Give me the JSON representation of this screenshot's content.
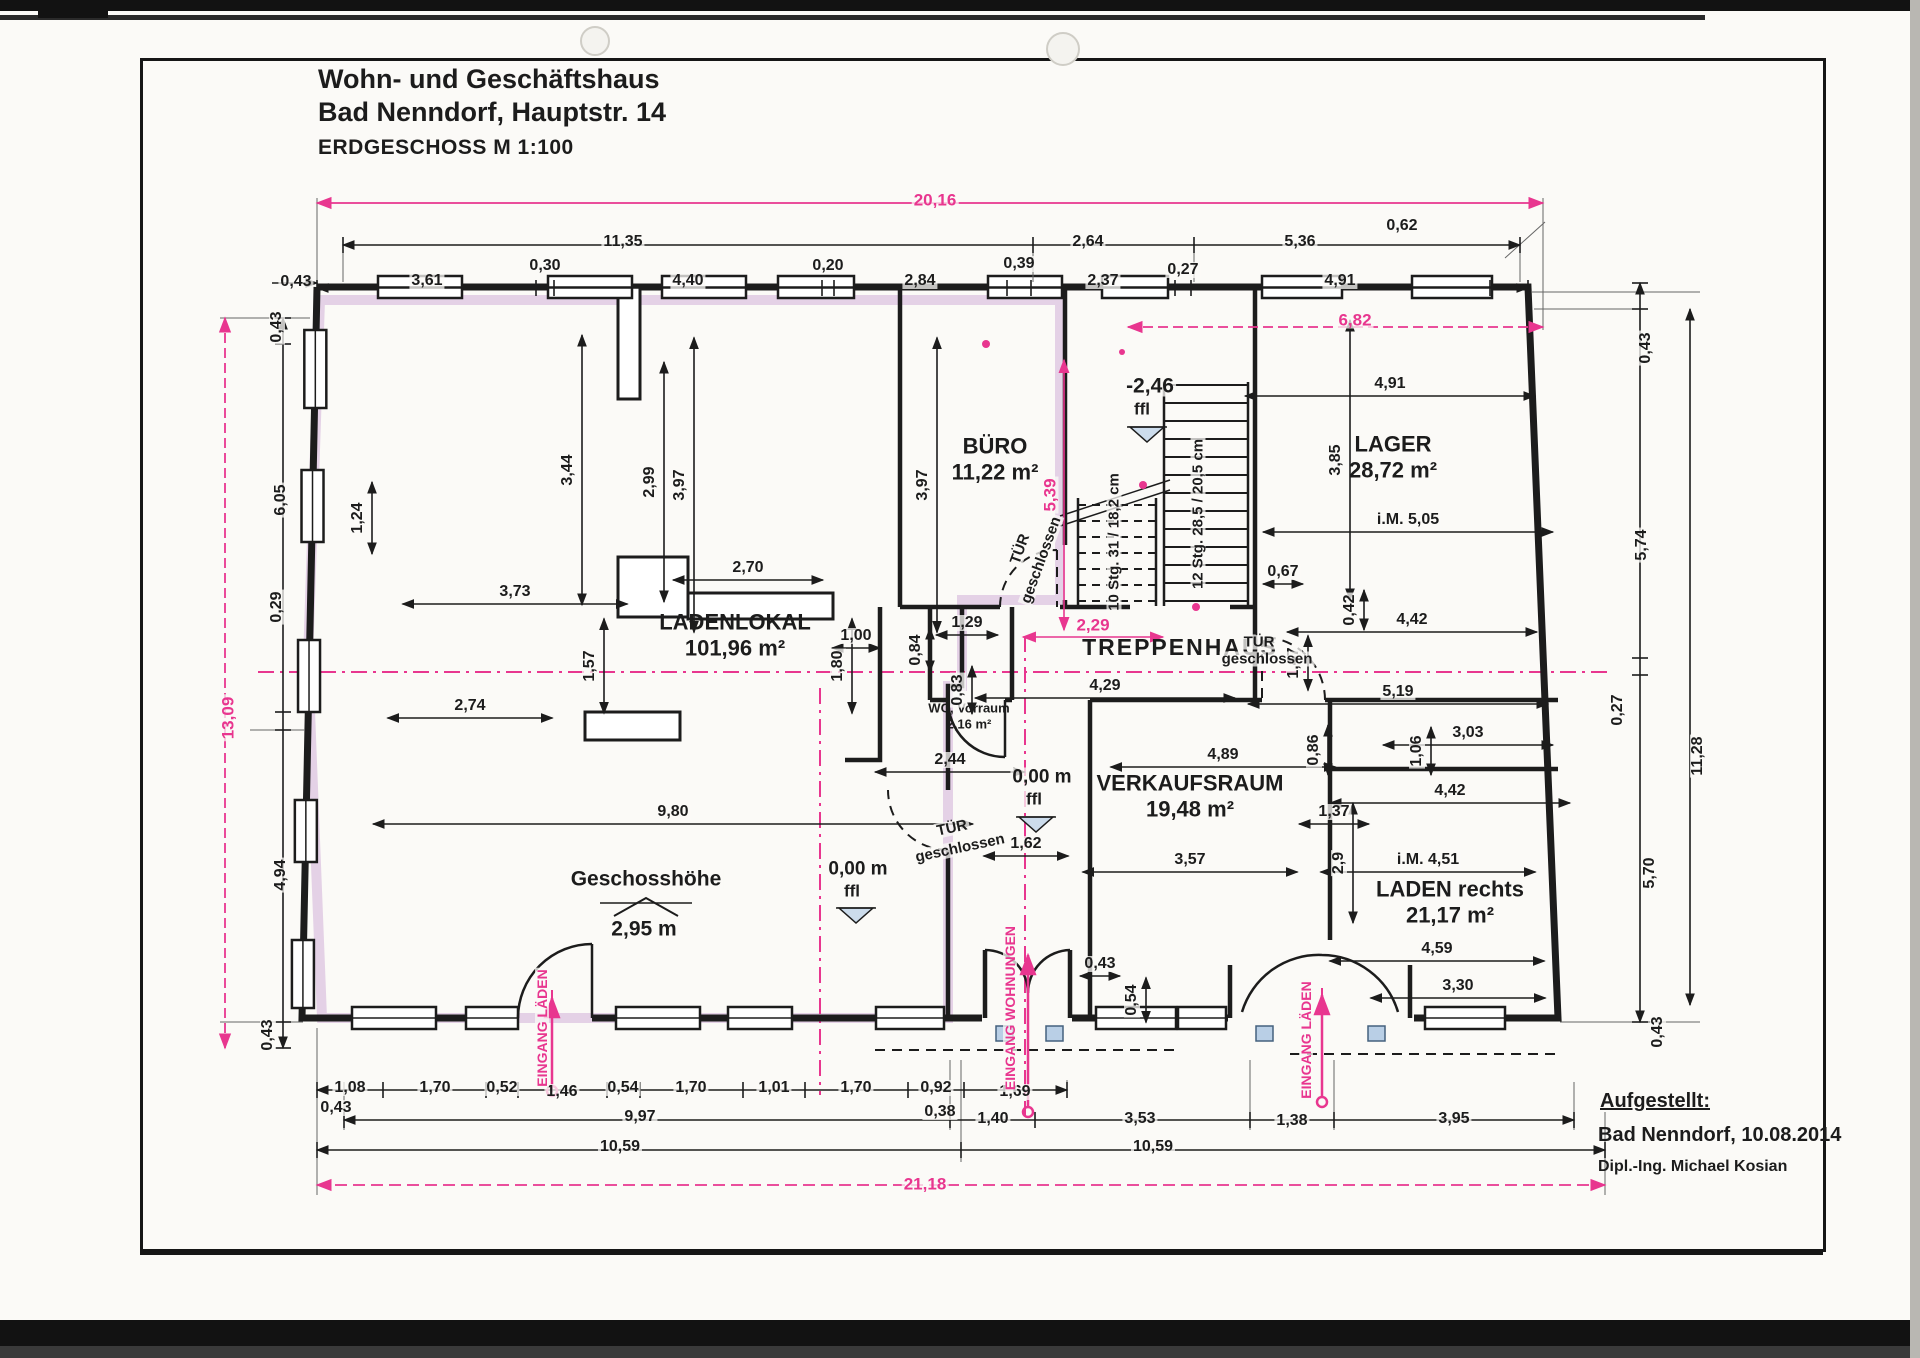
{
  "title": {
    "line1": "Wohn- und Geschäftshaus",
    "line2": "Bad Nenndorf, Hauptstr. 14",
    "scale_label": "ERDGESCHOSS M 1:100"
  },
  "attribution": {
    "heading": "Aufgestellt:",
    "line1": "Bad Nenndorf, 10.08.2014",
    "line2": "Dipl.-Ing. Michael Kosian"
  },
  "colors": {
    "ink": "#1c1c1c",
    "accent_pink": "#e8368f",
    "wall_highlight": "#c79fd0",
    "window_blue": "#b9cfe6",
    "paper": "#fbfaf7"
  },
  "rooms": [
    {
      "name": "LADENLOKAL",
      "area": "101,96 m²",
      "x": 735,
      "y": 636,
      "size": 22
    },
    {
      "name": "BÜRO",
      "area": "11,22 m²",
      "x": 995,
      "y": 460,
      "size": 22
    },
    {
      "name": "LAGER",
      "area": "28,72 m²",
      "x": 1393,
      "y": 458,
      "size": 22
    },
    {
      "name": "TREPPENHAUS",
      "area": "",
      "x": 1180,
      "y": 648,
      "size": 23
    },
    {
      "name": "VERKAUFSRAUM",
      "area": "19,48 m²",
      "x": 1190,
      "y": 797,
      "size": 22
    },
    {
      "name": "LADEN rechts",
      "area": "21,17 m²",
      "x": 1450,
      "y": 903,
      "size": 22
    },
    {
      "name": "WC, Vorraum",
      "area": "2,16 m²",
      "x": 969,
      "y": 716,
      "size": 13
    }
  ],
  "annotations": [
    {
      "t": "TÜR",
      "x": 1020,
      "y": 549,
      "rot": -70,
      "size": 15
    },
    {
      "t": "geschlossen",
      "x": 1041,
      "y": 560,
      "rot": -70,
      "size": 15
    },
    {
      "t": "TÜR",
      "x": 1259,
      "y": 642,
      "size": 15
    },
    {
      "t": "geschlossen",
      "x": 1267,
      "y": 659,
      "size": 15
    },
    {
      "t": "TÜR",
      "x": 952,
      "y": 828,
      "rot": -12,
      "size": 15
    },
    {
      "t": "geschlossen",
      "x": 960,
      "y": 848,
      "rot": -12,
      "size": 15
    },
    {
      "t": "10 Stg. 31 / 18,2 cm",
      "x": 1114,
      "y": 542,
      "rot": -90,
      "size": 15
    },
    {
      "t": "12 Stg. 28,5 / 20,5 cm",
      "x": 1198,
      "y": 514,
      "rot": -90,
      "size": 15
    },
    {
      "t": "-2,46",
      "x": 1150,
      "y": 386,
      "size": 21
    },
    {
      "t": "ffl",
      "x": 1142,
      "y": 409,
      "size": 17
    },
    {
      "t": "0,00 m",
      "x": 858,
      "y": 869,
      "size": 19
    },
    {
      "t": "ffl",
      "x": 852,
      "y": 891,
      "size": 17
    },
    {
      "t": "0,00 m",
      "x": 1042,
      "y": 777,
      "size": 19
    },
    {
      "t": "ffl",
      "x": 1034,
      "y": 799,
      "size": 17
    },
    {
      "t": "Geschosshöhe",
      "x": 646,
      "y": 879,
      "size": 21
    },
    {
      "t": "2,95 m",
      "x": 644,
      "y": 929,
      "size": 21
    },
    {
      "t": "EINGANG LÄDEN",
      "x": 542,
      "y": 1028,
      "rot": -90,
      "pink": true,
      "size": 14
    },
    {
      "t": "EINGANG WOHNUNGEN",
      "x": 1010,
      "y": 1008,
      "rot": -90,
      "pink": true,
      "size": 14
    },
    {
      "t": "EINGANG LÄDEN",
      "x": 1306,
      "y": 1040,
      "rot": -90,
      "pink": true,
      "size": 14
    }
  ],
  "dims_black": [
    {
      "t": "0,43",
      "x": 296,
      "y": 282
    },
    {
      "t": "11,35",
      "x": 623,
      "y": 242
    },
    {
      "t": "2,64",
      "x": 1088,
      "y": 242
    },
    {
      "t": "5,36",
      "x": 1300,
      "y": 242
    },
    {
      "t": "3,61",
      "x": 427,
      "y": 281
    },
    {
      "t": "0,30",
      "x": 545,
      "y": 266
    },
    {
      "t": "4,40",
      "x": 688,
      "y": 281
    },
    {
      "t": "0,20",
      "x": 828,
      "y": 266
    },
    {
      "t": "2,84",
      "x": 920,
      "y": 281
    },
    {
      "t": "0,39",
      "x": 1019,
      "y": 264
    },
    {
      "t": "2,37",
      "x": 1103,
      "y": 281
    },
    {
      "t": "0,27",
      "x": 1183,
      "y": 270
    },
    {
      "t": "4,91",
      "x": 1340,
      "y": 281
    },
    {
      "t": "0,62",
      "x": 1402,
      "y": 226
    },
    {
      "t": "0,43",
      "x": 277,
      "y": 327,
      "r": 1
    },
    {
      "t": "6,05",
      "x": 281,
      "y": 500,
      "r": 1
    },
    {
      "t": "0,29",
      "x": 277,
      "y": 607,
      "r": 1
    },
    {
      "t": "4,94",
      "x": 281,
      "y": 875,
      "r": 1
    },
    {
      "t": "0,43",
      "x": 268,
      "y": 1035,
      "r": 1
    },
    {
      "t": "0,43",
      "x": 1646,
      "y": 348,
      "r": 1
    },
    {
      "t": "5,74",
      "x": 1642,
      "y": 545,
      "r": 1
    },
    {
      "t": "0,27",
      "x": 1618,
      "y": 710,
      "r": 1
    },
    {
      "t": "5,70",
      "x": 1650,
      "y": 873,
      "r": 1
    },
    {
      "t": "0,43",
      "x": 1658,
      "y": 1032,
      "r": 1
    },
    {
      "t": "11,28",
      "x": 1698,
      "y": 756,
      "r": 1
    },
    {
      "t": "0,43",
      "x": 336,
      "y": 1108
    },
    {
      "t": "1,08",
      "x": 350,
      "y": 1088
    },
    {
      "t": "1,70",
      "x": 435,
      "y": 1088
    },
    {
      "t": "0,52",
      "x": 502,
      "y": 1088
    },
    {
      "t": "1,46",
      "x": 562,
      "y": 1092
    },
    {
      "t": "0,54",
      "x": 623,
      "y": 1088
    },
    {
      "t": "1,70",
      "x": 691,
      "y": 1088
    },
    {
      "t": "1,01",
      "x": 774,
      "y": 1088
    },
    {
      "t": "1,70",
      "x": 856,
      "y": 1088
    },
    {
      "t": "0,92",
      "x": 936,
      "y": 1088
    },
    {
      "t": "1,69",
      "x": 1015,
      "y": 1092
    },
    {
      "t": "0,38",
      "x": 940,
      "y": 1112
    },
    {
      "t": "9,97",
      "x": 640,
      "y": 1117
    },
    {
      "t": "1,40",
      "x": 993,
      "y": 1119
    },
    {
      "t": "3,53",
      "x": 1140,
      "y": 1119
    },
    {
      "t": "1,38",
      "x": 1292,
      "y": 1121
    },
    {
      "t": "3,95",
      "x": 1454,
      "y": 1119
    },
    {
      "t": "10,59",
      "x": 620,
      "y": 1147
    },
    {
      "t": "10,59",
      "x": 1153,
      "y": 1147
    },
    {
      "t": "3,44",
      "x": 568,
      "y": 470,
      "r": 1,
      "l": 270
    },
    {
      "t": "2,99",
      "x": 650,
      "y": 482,
      "r": 1,
      "l": 240
    },
    {
      "t": "3,97",
      "x": 680,
      "y": 485,
      "r": 1,
      "l": 295
    },
    {
      "t": "3,97",
      "x": 923,
      "y": 485,
      "r": 1,
      "l": 295
    },
    {
      "t": "2,70",
      "x": 748,
      "y": 568,
      "l": 150
    },
    {
      "t": "3,73",
      "x": 515,
      "y": 592,
      "l": 225
    },
    {
      "t": "1,24",
      "x": 358,
      "y": 518,
      "r": 1,
      "l": 72
    },
    {
      "t": "1,57",
      "x": 590,
      "y": 666,
      "r": 1,
      "l": 95
    },
    {
      "t": "2,74",
      "x": 470,
      "y": 706,
      "l": 165
    },
    {
      "t": "9,80",
      "x": 673,
      "y": 812,
      "l": 600
    },
    {
      "t": "1,00",
      "x": 856,
      "y": 636,
      "l": 48
    },
    {
      "t": "1,80",
      "x": 838,
      "y": 666,
      "r": 1,
      "l": 95
    },
    {
      "t": "2,44",
      "x": 950,
      "y": 760,
      "l": 150
    },
    {
      "t": "1,29",
      "x": 967,
      "y": 623,
      "l": 62
    },
    {
      "t": "0,84",
      "x": 916,
      "y": 650,
      "r": 1,
      "l": 44
    },
    {
      "t": "0,83",
      "x": 958,
      "y": 690,
      "r": 1,
      "l": 48
    },
    {
      "t": "4,29",
      "x": 1105,
      "y": 686,
      "l": 260
    },
    {
      "t": "5,19",
      "x": 1398,
      "y": 692,
      "l": 300
    },
    {
      "t": "4,91",
      "x": 1390,
      "y": 384,
      "l": 290
    },
    {
      "t": "3,85",
      "x": 1336,
      "y": 460,
      "r": 1,
      "l": 280
    },
    {
      "t": "i.M. 5,05",
      "x": 1408,
      "y": 520,
      "l": 290
    },
    {
      "t": "0,67",
      "x": 1283,
      "y": 572,
      "l": 40
    },
    {
      "t": "0,42",
      "x": 1350,
      "y": 610,
      "r": 1,
      "l": 40
    },
    {
      "t": "4,42",
      "x": 1412,
      "y": 620,
      "l": 250
    },
    {
      "t": "1,47",
      "x": 1294,
      "y": 663,
      "r": 1,
      "l": 55
    },
    {
      "t": "4,89",
      "x": 1223,
      "y": 755,
      "l": 225
    },
    {
      "t": "0,86",
      "x": 1314,
      "y": 750,
      "r": 1,
      "l": 50
    },
    {
      "t": "3,03",
      "x": 1468,
      "y": 733,
      "l": 170
    },
    {
      "t": "1,06",
      "x": 1417,
      "y": 751,
      "r": 1,
      "l": 48
    },
    {
      "t": "4,42",
      "x": 1450,
      "y": 791,
      "l": 240
    },
    {
      "t": "1,37",
      "x": 1334,
      "y": 812,
      "l": 70
    },
    {
      "t": "2,9",
      "x": 1339,
      "y": 863,
      "r": 1,
      "l": 120
    },
    {
      "t": "3,57",
      "x": 1190,
      "y": 860,
      "l": 215
    },
    {
      "t": "i.M. 4,51",
      "x": 1428,
      "y": 860,
      "l": 215
    },
    {
      "t": "4,59",
      "x": 1437,
      "y": 949,
      "l": 215
    },
    {
      "t": "3,30",
      "x": 1458,
      "y": 986,
      "l": 175
    },
    {
      "t": "0,43",
      "x": 1100,
      "y": 964,
      "l": 40
    },
    {
      "t": "0,54",
      "x": 1132,
      "y": 1000,
      "r": 1,
      "l": 45
    },
    {
      "t": "1,62",
      "x": 1026,
      "y": 844,
      "l": 85
    }
  ],
  "dims_pink": [
    {
      "t": "20,16",
      "x": 935,
      "y": 200
    },
    {
      "t": "13,09",
      "x": 228,
      "y": 718,
      "r": 1
    },
    {
      "t": "6,82",
      "x": 1355,
      "y": 320
    },
    {
      "t": "21,18",
      "x": 925,
      "y": 1184
    },
    {
      "t": "2,29",
      "x": 1093,
      "y": 625,
      "l": 140
    },
    {
      "t": "5,39",
      "x": 1050,
      "y": 495,
      "r": 1,
      "l": 270
    }
  ]
}
